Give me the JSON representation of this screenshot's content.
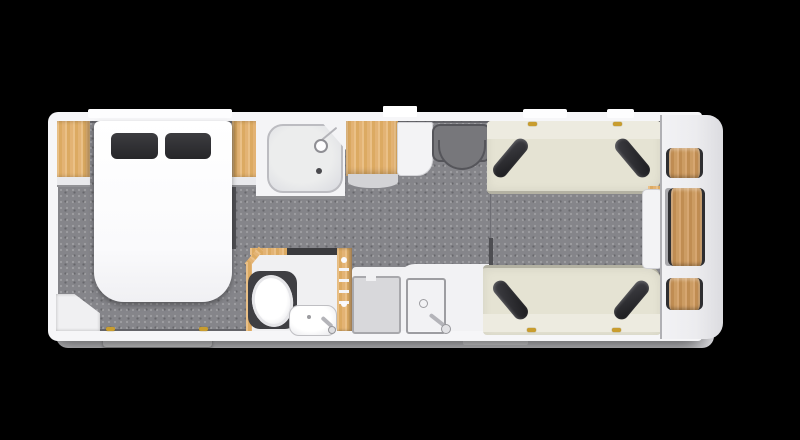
{
  "meta": {
    "view": "caravan-floorplan-top-down",
    "background_color": "#000000",
    "body_color": "#f6f6f8",
    "floor_color": "#85858a",
    "wood_color": "#ddab63",
    "upholstery_color": "#e5e3d3",
    "cushion_color": "#2b2b2e",
    "hinge_color": "#c99d2e"
  },
  "areas": {
    "front_bedroom": {
      "fixtures": [
        "wardrobe-left",
        "island-bed",
        "pillow-left",
        "pillow-right",
        "wardrobe-right",
        "corner-cabinet",
        "exterior-step"
      ]
    },
    "mid_washroom": {
      "fixtures": [
        "shower-cubicle",
        "shower-head",
        "shower-drain",
        "toilet",
        "washbasin",
        "basin-tap",
        "towel-ladder"
      ]
    },
    "mid_kitchen": {
      "fixtures": [
        "tall-cabinet",
        "side-unit",
        "entry-step-mat",
        "appliance-unit",
        "sink",
        "sink-drain",
        "sink-tap"
      ]
    },
    "rear_lounge": {
      "fixtures": [
        "sofa-top",
        "sofa-bottom",
        "scatter-cushions-x4",
        "side-chest",
        "rear-table-small-top",
        "rear-table-large",
        "rear-table-small-bottom"
      ]
    },
    "exterior": {
      "fixtures": [
        "door-marker",
        "window-marker-front",
        "window-marker-top-1",
        "window-marker-top-2",
        "window-marker-bottom",
        "skirt",
        "hinge-markers-x6"
      ]
    }
  }
}
